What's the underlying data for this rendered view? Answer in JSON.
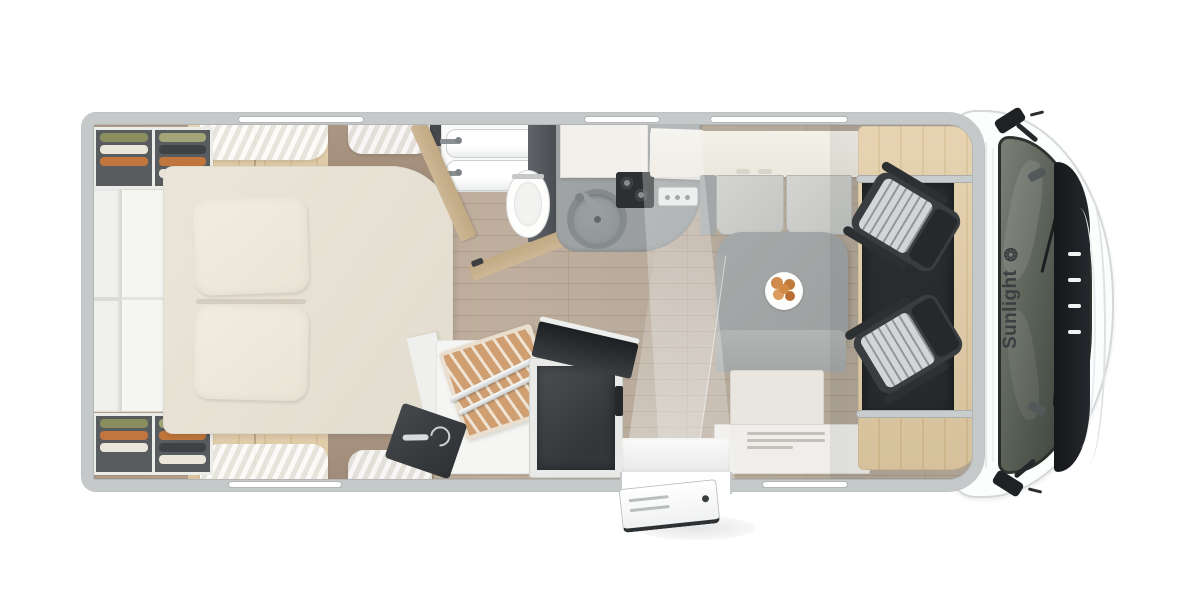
{
  "brand": {
    "name": "Sunlight",
    "logo_glyph": "❂",
    "logo_icon": "sun-icon"
  },
  "colors": {
    "wall": "#c6c9ca",
    "floor_a": "#bfae9d",
    "floor_b": "#b1a08f",
    "oak": "#e3cda6",
    "oak_dark": "#d9c094",
    "oak_gray": "#ab9683",
    "bed": "#eae5d8",
    "pillow": "#f2ede1",
    "cream": "#ebe8dd",
    "cushion": "#d4d5d2",
    "table": "#9da0a0",
    "dark_unit": "#3f4346",
    "cab_floor": "#26292b",
    "seat_dark": "#3a3d40",
    "seat_stripe": "#d3d6d6",
    "tan_door": "#cdb795",
    "shower_wood": "#cf9f72",
    "brand_text": "#3b3f41",
    "body_white": "#fcfdfd",
    "clothes_olive": "#8a8d5d",
    "clothes_orange": "#c0763c",
    "clothes_cream": "#eae6da",
    "clothes_dark": "#3f4244",
    "clothes_sage": "#a3a478"
  }
}
